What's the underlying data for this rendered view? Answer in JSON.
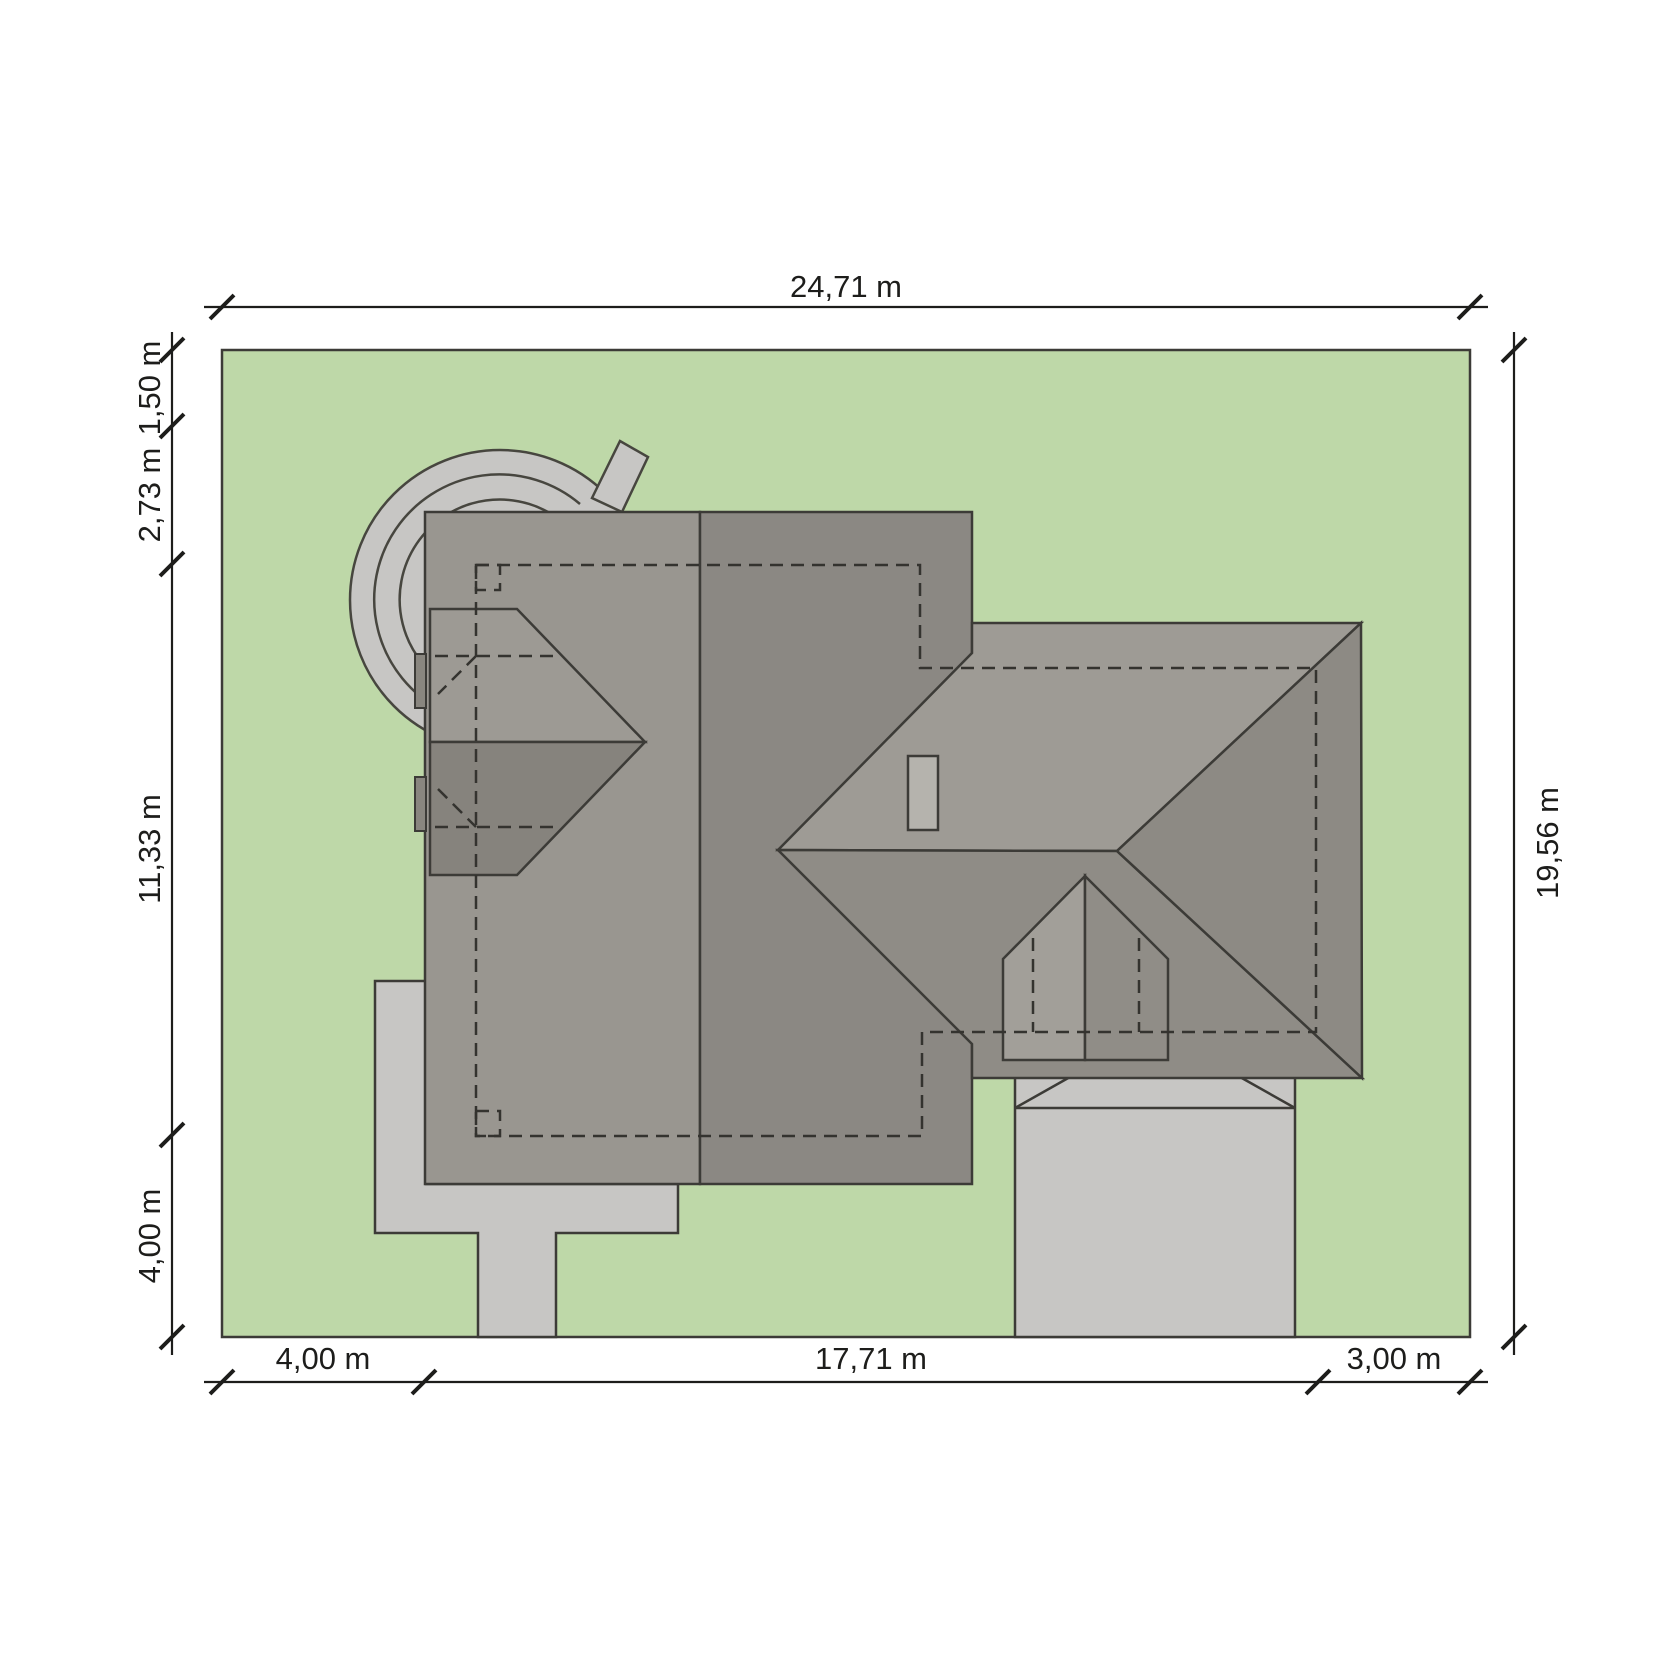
{
  "drawing": {
    "type": "architectural-site-plan",
    "view": "roof top view of house on plot"
  },
  "dimensions": {
    "top": {
      "label": "24,71 m"
    },
    "right": {
      "label": "19,56 m"
    },
    "left": [
      {
        "label": "1,50 m"
      },
      {
        "label": "2,73 m"
      },
      {
        "label": "11,33 m"
      },
      {
        "label": "4,00 m"
      }
    ],
    "bottom": [
      {
        "label": "4,00 m"
      },
      {
        "label": "17,71 m"
      },
      {
        "label": "3,00 m"
      }
    ]
  },
  "colors": {
    "background": "#ffffff",
    "plot_green": "#bed8a8",
    "hardscape_gray": "#c7c6c4",
    "roof_west_face": "#999690",
    "roof_east_face": "#8b8883",
    "bigroof_north_face": "#9e9b95",
    "bigroof_south_face": "#8f8c86",
    "bigroof_hip_face": "#8d8a84",
    "bay_upper_face": "#9d9a94",
    "bay_lower_face": "#86837d",
    "bay_stub": "#89867f",
    "dormer_left_face": "#a29f99",
    "dormer_right_face": "#908d87",
    "chimney_gray": "#b5b3ad",
    "outline": "#3c3b37",
    "dimension_ink": "#1d1d1b"
  }
}
